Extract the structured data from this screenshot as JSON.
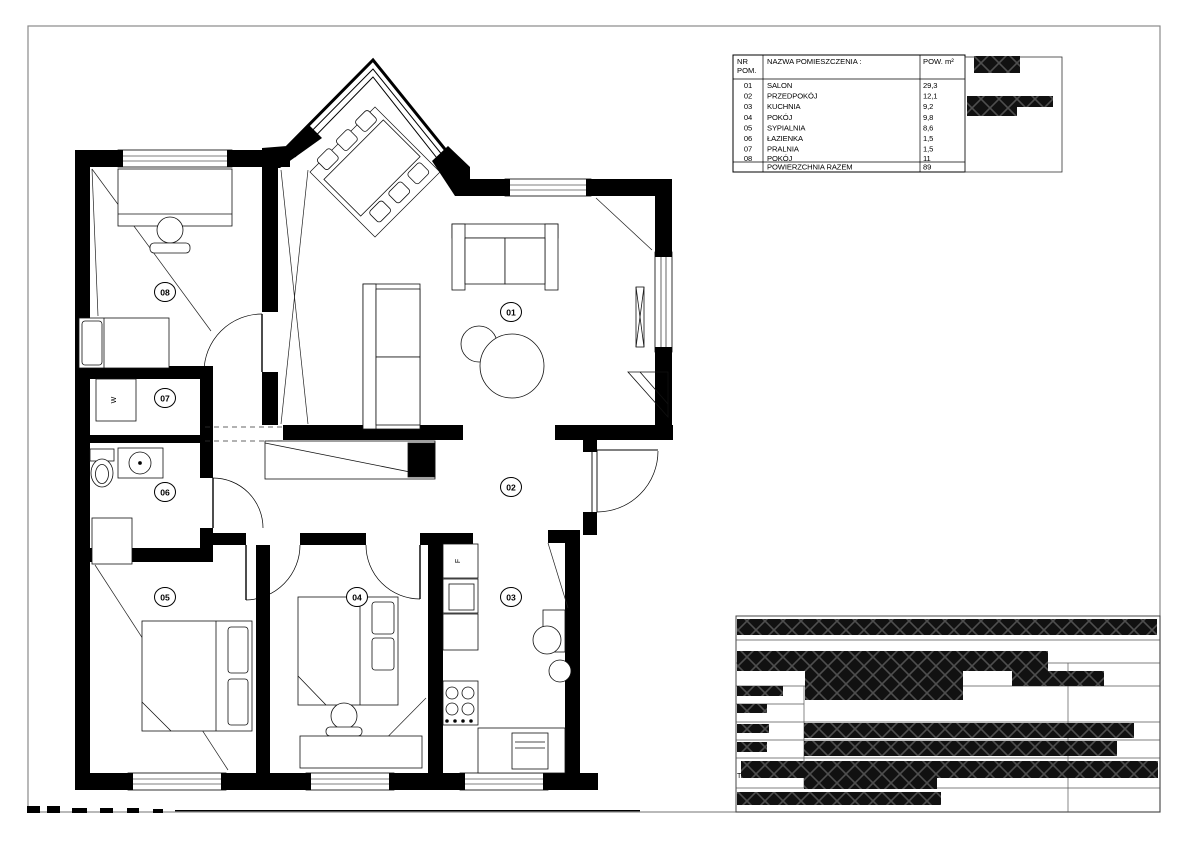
{
  "rooms_table": {
    "header": {
      "col_nr_line1": "NR",
      "col_nr_line2": "POM.",
      "col_name": "NAZWA POMIESZCZENIA :",
      "col_area": "POW. m²"
    },
    "rows": [
      {
        "nr": "01",
        "name": "SALON",
        "area": "29,3"
      },
      {
        "nr": "02",
        "name": "PRZEDPOKÓJ",
        "area": "12,1"
      },
      {
        "nr": "03",
        "name": "KUCHNIA",
        "area": "9,2"
      },
      {
        "nr": "04",
        "name": "POKÓJ",
        "area": "9,8"
      },
      {
        "nr": "05",
        "name": "SYPIALNIA",
        "area": "8,6"
      },
      {
        "nr": "06",
        "name": "ŁAZIENKA",
        "area": "1,5"
      },
      {
        "nr": "07",
        "name": "PRALNIA",
        "area": "1,5"
      },
      {
        "nr": "08",
        "name": "POKÓJ",
        "area": "11"
      }
    ],
    "footer": {
      "label": "POWIERZCHNIA RAZEM",
      "value": "89"
    }
  },
  "plan": {
    "room_labels": [
      {
        "id": "01"
      },
      {
        "id": "02"
      },
      {
        "id": "03"
      },
      {
        "id": "04"
      },
      {
        "id": "05"
      },
      {
        "id": "06"
      },
      {
        "id": "07"
      },
      {
        "id": "08"
      }
    ],
    "appliance_labels": {
      "washer": "W",
      "fridge": "F"
    }
  },
  "title_block": {
    "stray_char": "T"
  },
  "colors": {
    "paper": "#ffffff",
    "wall_fill": "#000000",
    "line": "#1a1a1a",
    "sheet_border": "#8a8a8a",
    "redaction_fill": "#111111"
  }
}
